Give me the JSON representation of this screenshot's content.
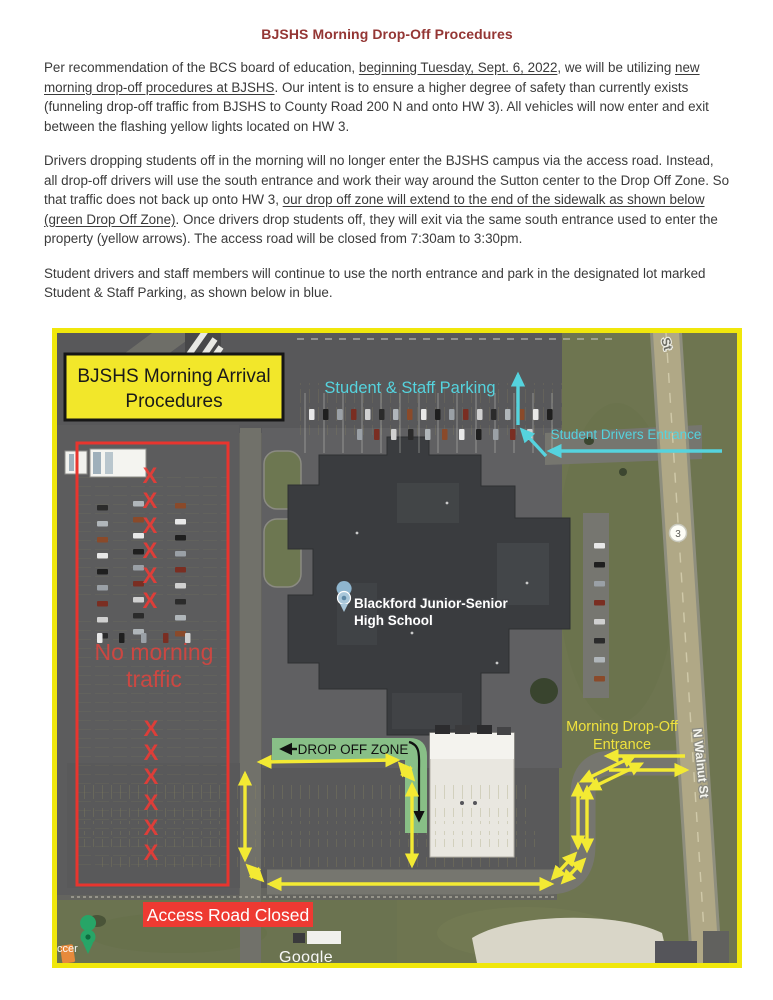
{
  "page": {
    "title": "BJSHS Morning Drop-Off Procedures",
    "title_color": "#943634"
  },
  "paragraphs": [
    {
      "segments": [
        {
          "t": "Per recommendation of the BCS board of education, "
        },
        {
          "t": "beginning Tuesday, Sept. 6, 2022",
          "u": true
        },
        {
          "t": ", we will be utilizing "
        },
        {
          "t": "new morning drop-off procedures at BJSHS",
          "u": true
        },
        {
          "t": ". Our intent is to ensure a higher degree of safety than currently exists (funneling drop-off traffic from BJSHS to County Road 200 N and onto HW 3). All vehicles will now enter and exit between the flashing yellow lights located on HW 3."
        }
      ]
    },
    {
      "segments": [
        {
          "t": "Drivers dropping students off in the morning will no longer enter the BJSHS campus via the access road. Instead, all drop-off drivers will use the south entrance and work their way around the Sutton center to the Drop Off Zone. So that traffic does not back up onto HW 3, "
        },
        {
          "t": "our drop off zone will extend to the end of the sidewalk as shown below (green Drop Off Zone)",
          "u": true
        },
        {
          "t": ". Once drivers drop students off, they will exit via the same south entrance used to enter the property (yellow arrows). The access road will be closed from 7:30am to 3:30pm."
        }
      ]
    },
    {
      "segments": [
        {
          "t": "Student drivers and staff members will continue to use the north entrance and park in the designated lot marked Student & Staff Parking, as shown below in blue."
        }
      ]
    }
  ],
  "map": {
    "arrival_box": {
      "line1": "BJSHS Morning Arrival",
      "line2": "Procedures"
    },
    "labels": {
      "student_staff_parking": "Student & Staff Parking",
      "student_drivers_entrance": "Student Drivers Entrance",
      "no_morning_line1": "No morning",
      "no_morning_line2": "traffic",
      "x_mark": "X",
      "drop_off_zone": "DROP OFF ZONE",
      "morning_drop_off_line1": "Morning Drop-Off",
      "morning_drop_off_line2": "Entrance",
      "access_road_closed": "Access Road Closed",
      "school_name_line1": "Blackford Junior-Senior",
      "school_name_line2": "High School",
      "n_walnut_st": "N Walnut St",
      "st_partial": "St",
      "route_shield": "3",
      "place_partial": "ccer",
      "attribution": "Google"
    },
    "colors": {
      "border_yellow": "#f0e70c",
      "annotation_cyan": "#55d3de",
      "annotation_red": "#e8352e",
      "annotation_yellow": "#f3ea33",
      "drop_zone_green": "#8cc88a",
      "banner_red": "#ee3a32"
    }
  }
}
